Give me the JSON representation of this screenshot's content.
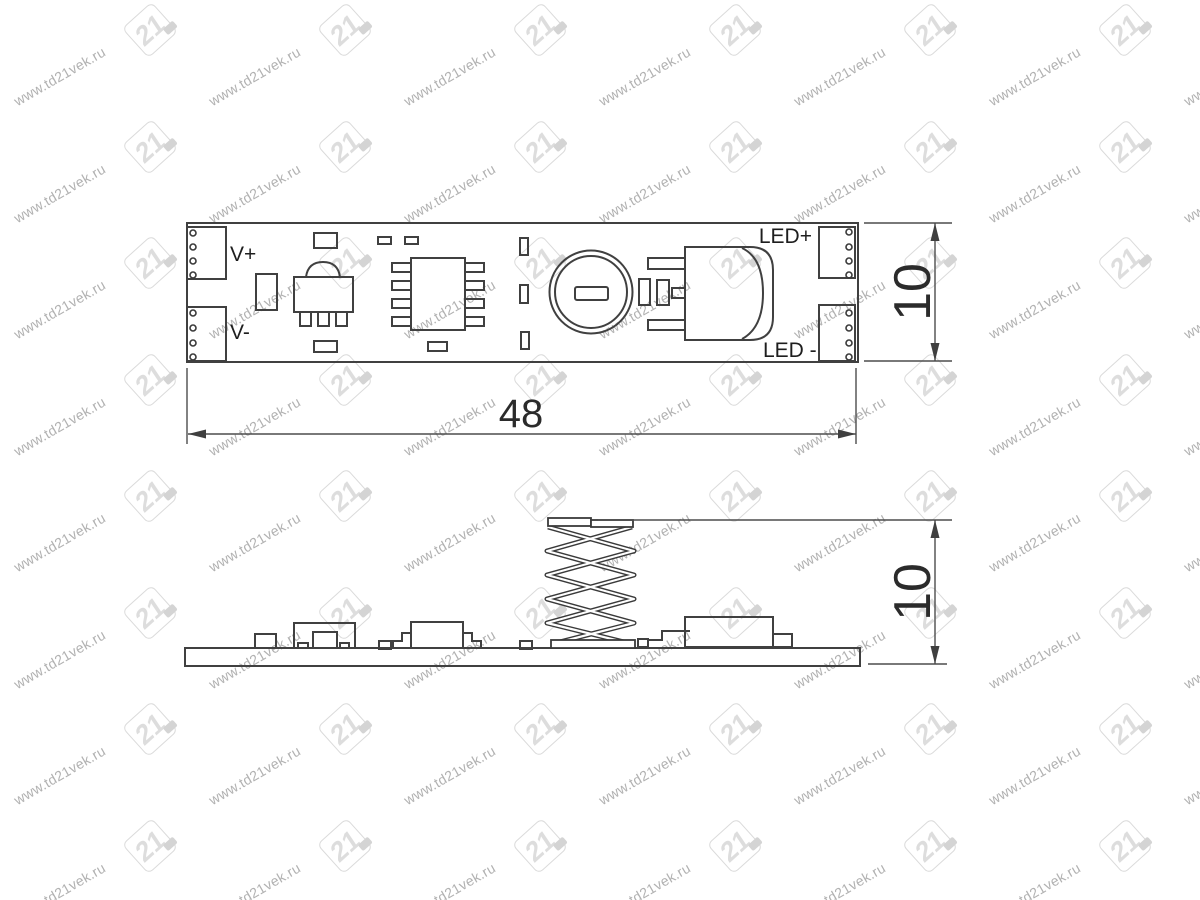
{
  "watermark": {
    "text": "www.td21vek.ru",
    "logo_text": "21"
  },
  "top_view": {
    "label_v_plus": "V+",
    "label_v_minus": "V-",
    "label_led_plus": "LED+",
    "label_led_minus": "LED -"
  },
  "dimensions": {
    "board_width": "48",
    "board_height": "10",
    "side_height": "10"
  },
  "colors": {
    "background": "#ffffff",
    "drawing_line": "#404040",
    "dimension_line": "#4d4d4d",
    "label_text": "#1e1e1e",
    "watermark_text": "#a9a9a9",
    "watermark_logo": "#d9d9d9"
  }
}
